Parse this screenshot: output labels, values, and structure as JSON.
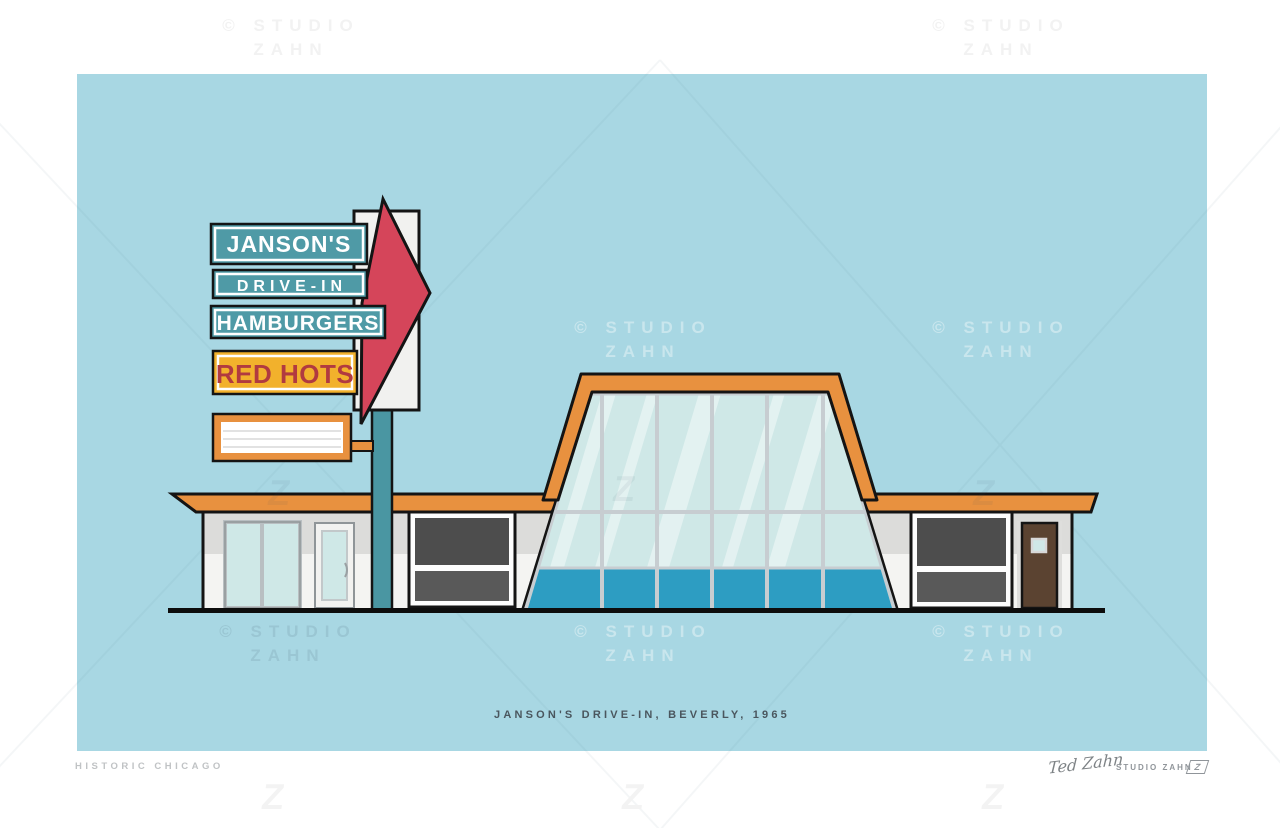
{
  "print": {
    "caption": "JANSON'S DRIVE-IN, BEVERLY, 1965",
    "series_label": "HISTORIC CHICAGO",
    "signature": "Ted Zahn",
    "studio_label": "STUDIO ZAHN",
    "studio_logo_letter": "Z"
  },
  "watermark": {
    "line1": "© STUDIO",
    "line2": "ZAHN",
    "z_glyph": "Z"
  },
  "sign": {
    "line1": "JANSON'S",
    "line2": "DRIVE-IN",
    "line3": "HAMBURGERS",
    "line4": "RED HOTS"
  },
  "palette": {
    "sky": "#a8d7e3",
    "orange": "#e8913f",
    "teal_sign": "#4f9aa6",
    "pole": "#4a96a2",
    "arrow_red": "#d5455a",
    "gold": "#f2b12c",
    "red_text": "#b13a40",
    "glass": "#cfe8e7",
    "glass_lower": "#2d9dc2",
    "wall": "#f4f4f2",
    "wall_shade": "#dcdcda",
    "window_dark": "#4d4d4d",
    "window_dark2": "#595959",
    "door_brown": "#5b4331",
    "mullion": "#c7cdd1",
    "outline": "#141414",
    "caption_text": "#4a565e",
    "footer_gray": "#c0c3c5",
    "studio_gray": "#90959a",
    "wm_on_white": "#f2f2f2"
  }
}
